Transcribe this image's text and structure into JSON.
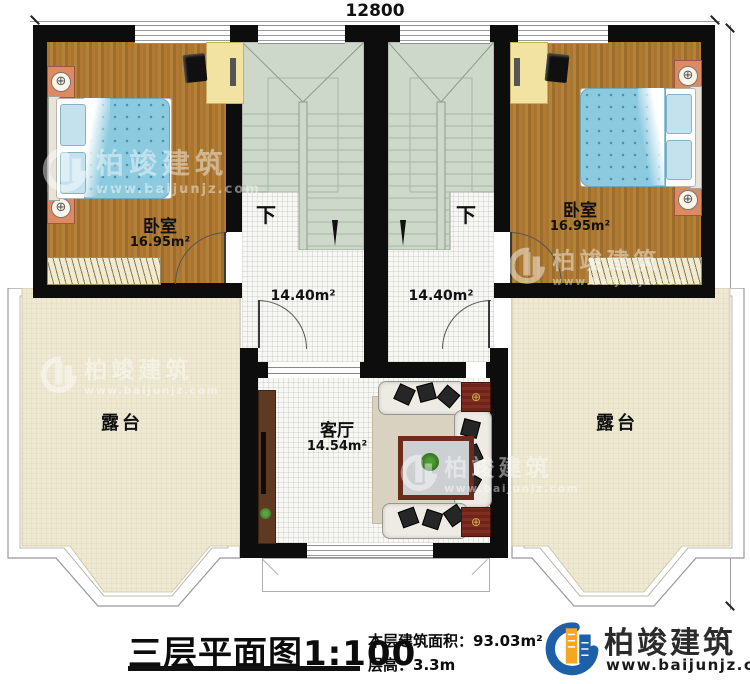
{
  "plan": {
    "dimensions": {
      "width_label": "12800",
      "height_label": "10600"
    },
    "rooms": {
      "bedroom_left": {
        "name": "卧室",
        "area": "16.95m²"
      },
      "bedroom_right": {
        "name": "卧室",
        "area": "16.95m²"
      },
      "stair_hall_left": {
        "area": "14.40m²",
        "direction_label": "下"
      },
      "stair_hall_right": {
        "area": "14.40m²",
        "direction_label": "下"
      },
      "living_room": {
        "name": "客厅",
        "area": "14.54m²"
      },
      "terrace_left": {
        "name": "露台"
      },
      "terrace_right": {
        "name": "露台"
      }
    }
  },
  "title_block": {
    "title": "三层平面图",
    "scale": "1:100",
    "area_label": "本层建筑面积：",
    "area_value": "93.03m²",
    "height_label": "层高：",
    "height_value": "3.3m"
  },
  "brand": {
    "name": "柏竣建筑",
    "website": "www.baijunjz.com"
  },
  "icons": {
    "lamp_glyph": "⊕",
    "knob_glyph": "⊕"
  },
  "colors": {
    "wall": "#0d0d0d",
    "wood_floor": "#ad7a33",
    "stair": "#cdd7ca",
    "terrace": "#eee9d2",
    "bed_blue": "#8ccadf",
    "mahogany": "#6e241a",
    "brand_blue": "#1d5fa8",
    "brand_orange": "#f5a623"
  }
}
